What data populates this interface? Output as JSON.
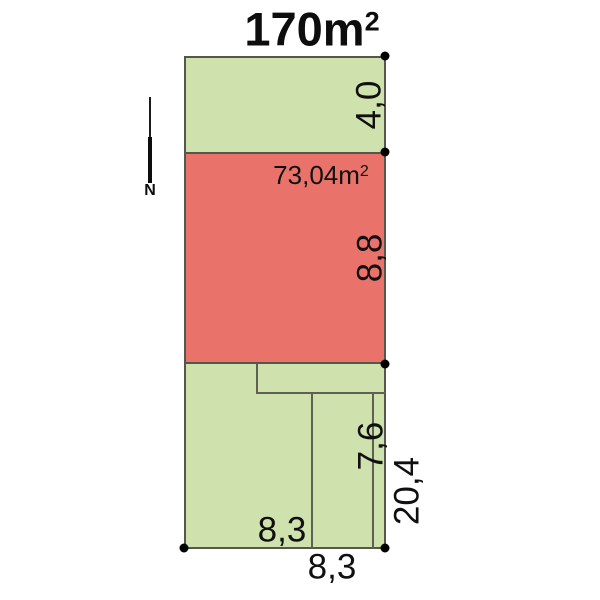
{
  "title": {
    "value": "170m",
    "sup": "2"
  },
  "north": {
    "label": "N"
  },
  "sections": {
    "front_yard": {
      "dim_depth": "4,0",
      "fill": "#cfe2ad"
    },
    "building": {
      "area_value": "73,04m",
      "area_sup": "2",
      "dim_depth": "8,8",
      "fill": "#e9736a"
    },
    "back_yard": {
      "dim_depth": "7,6",
      "dim_width_inner": "8,3",
      "fill": "#cfe2ad"
    }
  },
  "overall": {
    "dim_total_depth": "20,4",
    "dim_total_width": "8,3"
  },
  "colors": {
    "parcel_green": "#cfe2ad",
    "building_red": "#e9736a",
    "outline": "#54574b",
    "inner_line": "#5d6053",
    "marker_dot": "#000000"
  }
}
